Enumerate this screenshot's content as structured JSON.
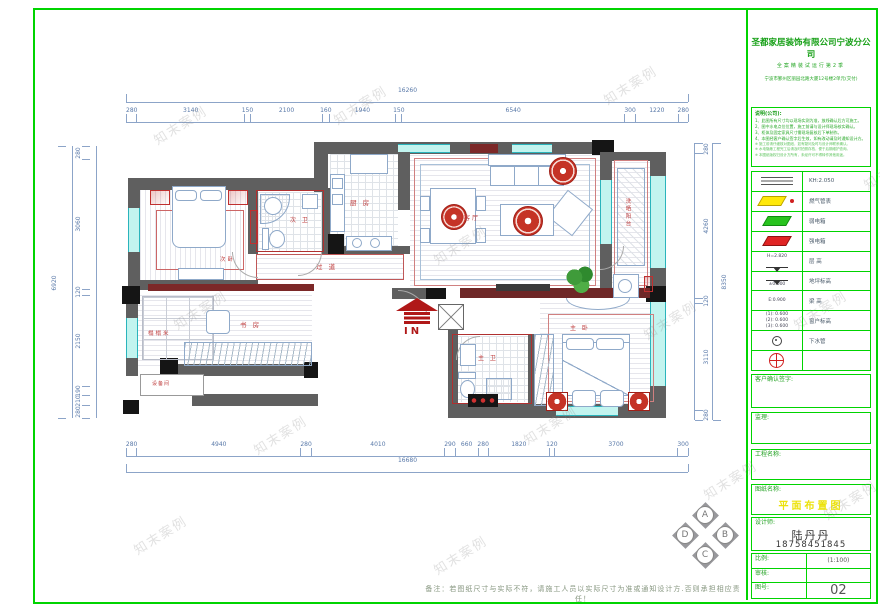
{
  "sheet": {
    "note": "备注：若图纸尺寸与实际不符，请施工人员以实际尺寸为准或通知设计方.否则承担相应责任！",
    "watermark": "知末案例"
  },
  "dimensions": {
    "top": {
      "overall": "16260",
      "segments": [
        "280",
        "3140",
        "150",
        "2100",
        "160",
        "1940",
        "150",
        "6540",
        "300",
        "1220",
        "280"
      ]
    },
    "bottom": {
      "overall": "16680",
      "segments": [
        "280",
        "4940",
        "280",
        "4010",
        "290",
        "660",
        "280",
        "1820",
        "120",
        "3700",
        "300"
      ]
    },
    "left": {
      "overall": "6920",
      "segments": [
        "280",
        "3060",
        "120",
        "2150",
        "190",
        "210",
        "280"
      ]
    },
    "right": {
      "overall": "8350",
      "segments": [
        "280",
        "4260",
        "120",
        "3110",
        "280"
      ]
    }
  },
  "plan": {
    "rooms": {
      "bedroom2": "次卧",
      "bath2": "次 卫",
      "kitchen": "厨 房",
      "living_dining": "餐客厅",
      "laundry_balcony": "洗晒阳台",
      "corridor": "过 道",
      "study": "书 房",
      "tatami": "榻榻米",
      "equipment": "设备间",
      "master_bath": "主 卫",
      "master_bedroom": "主 卧"
    },
    "entry_label": "IN",
    "compass": {
      "top": "A",
      "left": "D",
      "right": "B",
      "bottom": "C"
    }
  },
  "title_block": {
    "company": {
      "name": "圣都家居装饰有限公司宁波分公司",
      "slogan": "全案精装试运行第2季",
      "address": "宁波市鄞州区丽园北路大厦12号楼2单元(交付)"
    },
    "notes": {
      "title": "说明(公司):",
      "items": [
        "1、此图所有尺寸均以现场实测为准，放线确认后方可施工。",
        "2、图中水电点位位置，施工前请与设计师现场核实确认。",
        "3、柜体及固定家具尺寸需现场复核后下单制作。",
        "4、本图经客户确认签字后生效，如有改动请及时通知设计方。"
      ],
      "subs": [
        "※ 施工前请仔细核对图纸，如有疑问及时与设计师联系确认。",
        "※ 水电隐蔽工程完工后请及时拍照存档，便于后期维护查询。",
        "※ 本图纸版权归设计方所有，未经许可不得转作其他用途。"
      ]
    },
    "legend": {
      "rows": [
        {
          "icon": "lines",
          "left": "",
          "label": "KH:2.050"
        },
        {
          "icon": "gas",
          "left": "",
          "label": "燃气管表"
        },
        {
          "icon": "weak",
          "left": "",
          "label": "弱电箱"
        },
        {
          "icon": "strong",
          "left": "",
          "label": "强电箱"
        },
        {
          "icon": "htri",
          "left": "H=2.820",
          "label": "层 高"
        },
        {
          "icon": "level",
          "left": "±0.000",
          "label": "地坪标高"
        },
        {
          "icon": "text",
          "left": "E:0.900",
          "label": "梁 高"
        },
        {
          "icon": "multi",
          "left": "(1): 0.600|(2): 0.600|(3): 0.600",
          "label": "窗户标高"
        },
        {
          "icon": "drain",
          "left": "",
          "label": "下水管"
        },
        {
          "icon": "cross",
          "left": "",
          "label": ""
        }
      ]
    },
    "sign": {
      "label": "客户确认签字:"
    },
    "supervisor": {
      "label": "监理:"
    },
    "project": {
      "label": "工程名称:"
    },
    "drawing": {
      "label": "图纸名称:",
      "value": "平面布置图"
    },
    "designer": {
      "label": "设计师:",
      "name": "陆丹丹",
      "phone": "18758451845"
    },
    "table": {
      "scale_label": "比例:",
      "scale_value": "(1:100)",
      "check_label": "审核:",
      "check_value": "",
      "no_label": "图号:",
      "no_value": "02"
    }
  }
}
